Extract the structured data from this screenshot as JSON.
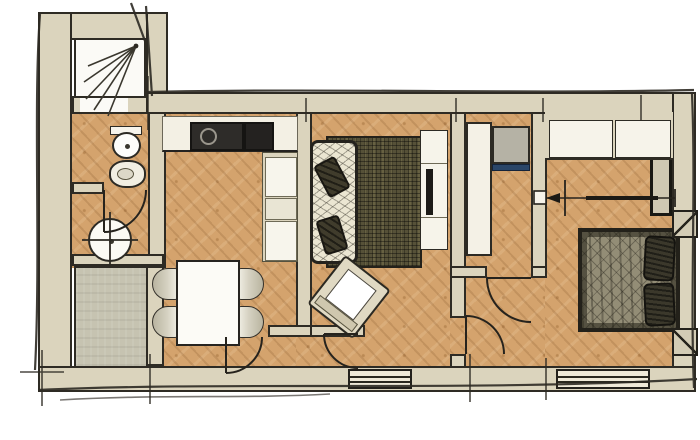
{
  "meta": {
    "title": "Hand-drawn apartment floor plan",
    "type": "architectural-floor-plan",
    "text_labels": []
  },
  "palette": {
    "canvas": "#ffffff",
    "wall": "#dbd4bd",
    "wallOutline": "#2e2b24",
    "wallOutlineDark": "#191813",
    "wood": "#d4a36d",
    "tile": "#c6c3b1",
    "white": "#f8f6ee",
    "cream": "#e9e5d4",
    "dark": "#2e2c29",
    "darker": "#242220",
    "rug": "#565138",
    "sofaFabric": "#ebe6d2",
    "cushion": "#403c2c",
    "bedDuvet": "#938d76",
    "pillow": "#3b382b",
    "accentBlue": "#2a4669",
    "chair": "#d6d2c2",
    "armFrame": "#e0d9c3",
    "ink": "#2d2a23"
  },
  "rooms": [
    {
      "id": "shower-room",
      "floor": "white",
      "fixtures": [
        "shower-spray"
      ]
    },
    {
      "id": "wc",
      "floor": "wood",
      "fixtures": [
        "toilet",
        "bidet"
      ]
    },
    {
      "id": "washroom",
      "floor": "wood",
      "fixtures": [
        "washbasin",
        "door-swing"
      ]
    },
    {
      "id": "storage",
      "floor": "gray-tile",
      "fixtures": []
    },
    {
      "id": "kitchen-dining",
      "floor": "wood",
      "fixtures": [
        "counter",
        "sink-cooktop",
        "tall-cabinets",
        "dining-table",
        "four-chairs"
      ]
    },
    {
      "id": "living-room",
      "floor": "wood",
      "fixtures": [
        "sofa",
        "two-cushions",
        "rug",
        "armchair",
        "tv-sideboard"
      ]
    },
    {
      "id": "hall",
      "floor": "wood",
      "fixtures": [
        "door-swing",
        "door-swing",
        "closet",
        "appliance-niche"
      ]
    },
    {
      "id": "bedroom",
      "floor": "wood",
      "fixtures": [
        "wardrobe",
        "sliding-door-symbol",
        "double-bed",
        "two-pillows",
        "two-nightstands",
        "window"
      ]
    }
  ],
  "symbols": [
    "door-swing-arc",
    "shower-spray-lines",
    "sliding-door-arrow",
    "window-triple-line",
    "sketch-overshoot-ticks"
  ]
}
